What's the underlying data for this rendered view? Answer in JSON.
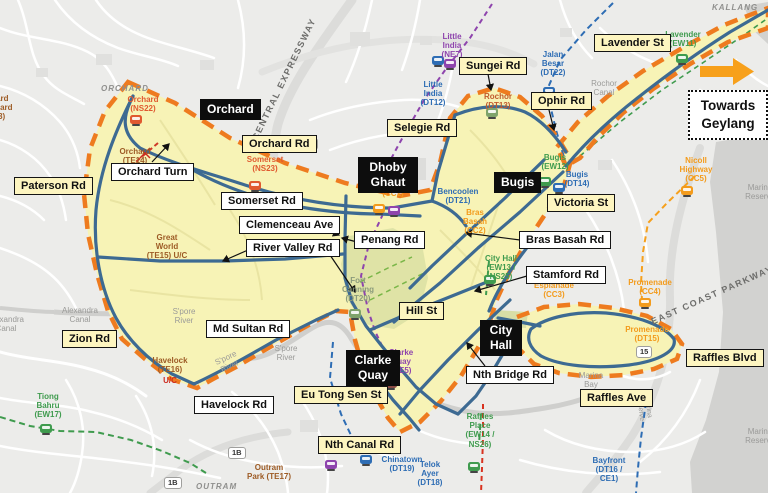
{
  "colors": {
    "cordon": "#EE7B1F",
    "zone_fill": "#F7F3B6",
    "park_fill": "#DFE3A6",
    "padang_fill": "#D8DEA6",
    "route_blue": "#3D6A92",
    "ns_red": "#E0592F",
    "ew_green": "#3F9B4E",
    "ne_purple": "#8E44AD",
    "dt_blue": "#2E6DB4",
    "cc_orange": "#F39B1C",
    "te_brown": "#9D5B25",
    "uc_red": "#CC2A1E",
    "rochor_orange": "#C05A2E",
    "muted_green": "#7FA36B",
    "maroon": "#8A4A44",
    "fortcanning_gray": "#8A9A7B",
    "water": "#D2D2D0",
    "arrow_orange": "#F7A01B"
  },
  "black_labels": {
    "orchard": "Orchard",
    "dhoby_ghaut": "Dhoby Ghaut",
    "bugis": "Bugis",
    "city_hall": "City Hall",
    "clarke_quay": "Clarke Quay"
  },
  "roads_yellow": {
    "paterson_rd": "Paterson Rd",
    "orchard_rd": "Orchard Rd",
    "selegie_rd": "Selegie Rd",
    "sungei_rd": "Sungei Rd",
    "ophir_rd": "Ophir Rd",
    "lavender_st": "Lavender St",
    "victoria_st": "Victoria St",
    "hill_st": "Hill St",
    "zion_rd": "Zion Rd",
    "eu_tong_sen_st": "Eu Tong Sen St",
    "nth_canal_rd": "Nth Canal Rd",
    "raffles_ave": "Raffles Ave",
    "raffles_blvd": "Raffles Blvd"
  },
  "roads_white": {
    "orchard_turn": "Orchard Turn",
    "somerset_rd": "Somerset Rd",
    "clemenceau_ave": "Clemenceau Ave",
    "river_valley_rd": "River Valley Rd",
    "penang_rd": "Penang Rd",
    "md_sultan_rd": "Md Sultan Rd",
    "havelock_rd": "Havelock Rd",
    "bras_basah_rd": "Bras Basah Rd",
    "stamford_rd": "Stamford Rd",
    "nth_bridge_rd": "Nth Bridge Rd"
  },
  "towards_box": {
    "line1": "Towards",
    "line2": "Geylang"
  },
  "stations": {
    "orchard_ns22": "Orchard (NS22)",
    "orchard_te14": "Orchard (TE14)",
    "orchard_blvd_te13": "Orchard Boulevard (TE13)",
    "somerset_ns23": "Somerset (NS23)",
    "dhoby_cc1": "(CC1)",
    "bencoolen_dt21": "Bencoolen (DT21)",
    "bras_basah_cc2": "Bras Basah (CC2)",
    "little_india_ne7": "Little India (NE7)",
    "little_india_dt12": "Little India (DT12)",
    "rochor_dt13": "Rochor (DT13)",
    "jalan_besar_dt22": "Jalan Besar (DT22)",
    "lavender_ew11": "Lavender (EW11)",
    "bugis_ew12": "Bugis (EW12)",
    "bugis_dt14": "Bugis (DT14)",
    "city_hall_ew13_ns25": "City Hall (EW13 / NS25)",
    "esplanade_cc3": "Esplanade (CC3)",
    "promenade_cc4": "Promenade (CC4)",
    "promenade_dt15": "Promenade (DT15)",
    "nicoll_highway_cc5": "Nicoll Highway (CC5)",
    "raffles_place": "Raffles Place (EW14 / NS26)",
    "tiong_bahru_ew17": "Tiong Bahru (EW17)",
    "outram_park_te17": "Outram Park (TE17)",
    "chinatown_dt19": "Chinatown (DT19)",
    "telok_ayer_dt18": "Telok Ayer (DT18)",
    "bayfront": "Bayfront (DT16 / CE1)",
    "clarke_quay_ne5": "Clarke Quay (NE5)",
    "fort_canning_dt20": "Fort Canning (DT20)",
    "great_world_te15": "Great World (TE15) U/C",
    "havelock_te16": "Havelock (TE16)",
    "havelock_uc": "U/C"
  },
  "areas": {
    "orchard": "ORCHARD",
    "kallang": "KALLANG",
    "outram": "OUTRAM"
  },
  "waterways": {
    "rochor_canal": "Rochor Canal",
    "alexandra_canal": "Alexandra Canal",
    "spore_river": "S'pore River",
    "marina_bay": "Marina Bay",
    "marina_reserve": "Marina Reserve"
  },
  "expressways": {
    "cte": "CENTRAL EXPRESSWAY",
    "ecp": "EAST COAST PARKWAY"
  },
  "badges": {
    "b4": "4",
    "b1b": "1B",
    "b15": "15"
  }
}
